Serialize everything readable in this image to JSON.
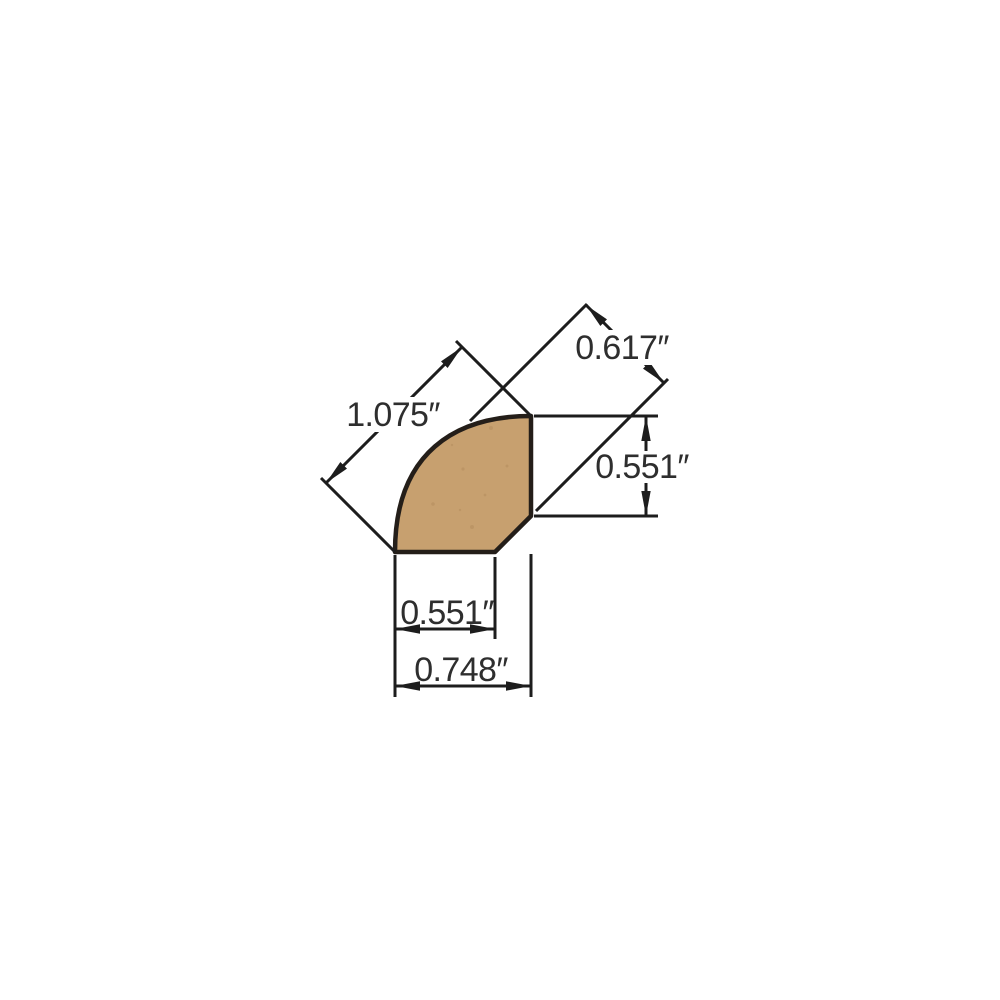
{
  "figure": {
    "subject": "quarter-round molding cross-section profile drawing",
    "units": "inches"
  },
  "colors": {
    "background": "#ffffff",
    "wood_fill": "#c7a06f",
    "wood_outline": "#241e19",
    "dimension_line": "#1d1d1d",
    "text": "#2e2e2e"
  },
  "dimensions": [
    {
      "id": "face-diagonal",
      "label": "0.617″",
      "orientation": "diagonal-45"
    },
    {
      "id": "overall-diagonal",
      "label": "1.075″",
      "orientation": "diagonal-45"
    },
    {
      "id": "side-height",
      "label": "0.551″",
      "orientation": "vertical"
    },
    {
      "id": "bottom-width",
      "label": "0.551″",
      "orientation": "horizontal"
    },
    {
      "id": "overall-width",
      "label": "0.748″",
      "orientation": "horizontal"
    }
  ]
}
